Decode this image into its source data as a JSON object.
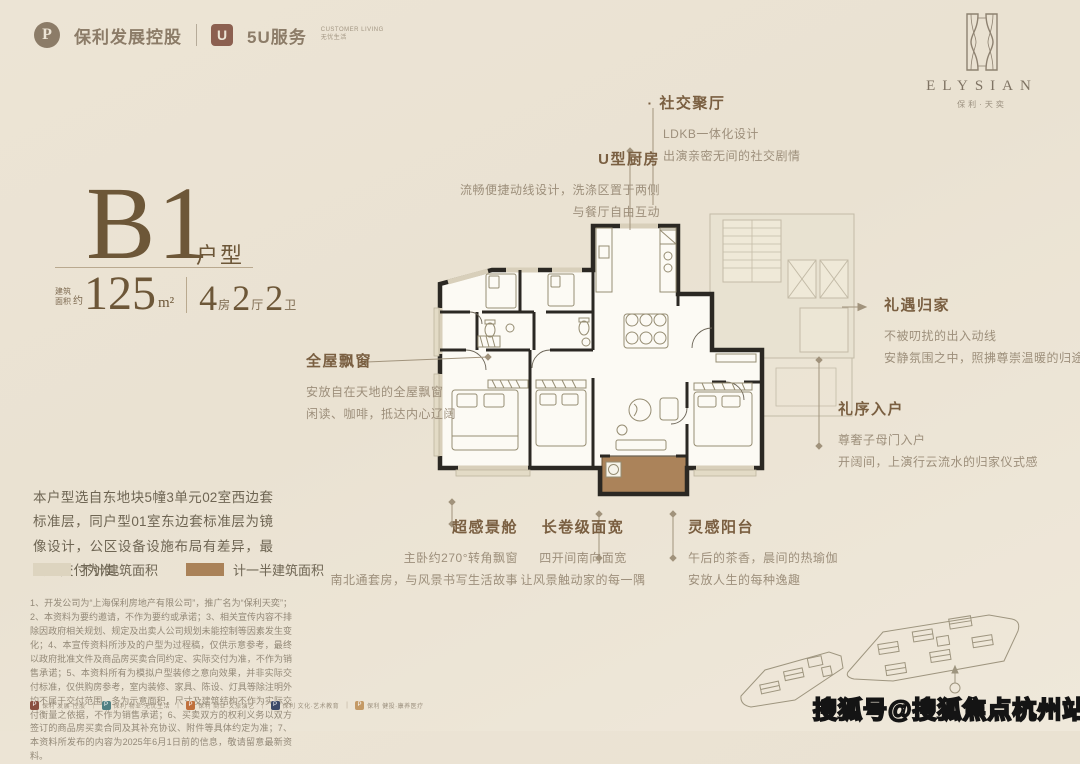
{
  "header": {
    "poly_logo": {
      "icon": "P",
      "name": "保利",
      "suffix": "发展控股"
    },
    "service_logo": {
      "icon": "U",
      "name": "5U服务",
      "sub1": "CUSTOMER LIVING",
      "sub2": "无忧生活"
    }
  },
  "brand": {
    "name_en": "ELYSIAN",
    "name_cn": "保利·天奕"
  },
  "unit": {
    "code": "B1",
    "type_label": "户型",
    "area_prefix_line1": "建筑",
    "area_prefix_line2": "面积",
    "area_approx": "约",
    "area_value": "125",
    "area_unit": "m²",
    "rooms": [
      {
        "num": "4",
        "label": "房"
      },
      {
        "num": "2",
        "label": "厅"
      },
      {
        "num": "2",
        "label": "卫"
      }
    ]
  },
  "description": "本户型选自东地块5幢3单元02室西边套标准层，同户型01室东边套标准层为镜像设计，公区设备设施布局有差异，最终以交付为准。",
  "legend": [
    {
      "label": "不计建筑面积",
      "color": "#ddd4bf"
    },
    {
      "label": "计一半建筑面积",
      "color": "#aa8258"
    }
  ],
  "annotations": {
    "social": {
      "title": "社交聚厅",
      "lines": [
        "LDKB一体化设计",
        "出演亲密无间的社交剧情"
      ]
    },
    "kitchen": {
      "title": "U型厨房",
      "lines": [
        "流畅便捷动线设计，洗涤区置于两侧",
        "与餐厅自由互动"
      ]
    },
    "homecoming": {
      "title": "礼遇归家",
      "lines": [
        "不被叨扰的出入动线",
        "安静氛围之中，照拂尊崇温暖的归途"
      ]
    },
    "entry": {
      "title": "礼序入户",
      "lines": [
        "尊奢子母门入户",
        "开阔间，上演行云流水的归家仪式感"
      ]
    },
    "baywindow": {
      "title": "全屋飘窗",
      "lines": [
        "安放自在天地的全屋飘窗",
        "闲读、咖啡，抵达内心辽阔"
      ]
    },
    "viewcabin": {
      "title": "超感景舱",
      "lines": [
        "主卧约270°转角飘窗",
        "南北通套房，与风景书写生活故事"
      ]
    },
    "frontwidth": {
      "title": "长卷级面宽",
      "lines": [
        "四开间南向面宽",
        "让风景触动家的每一隅"
      ]
    },
    "balcony": {
      "title": "灵感阳台",
      "lines": [
        "午后的茶香，晨间的热瑜伽",
        "安放人生的每种逸趣"
      ]
    }
  },
  "disclaimer": "1、开发公司为“上海保利房地产有限公司”，推广名为“保利天奕”；2、本资料为要约邀请，不作为要约或承诺；3、相关宣传内容不排除因政府相关规划、规定及出卖人公司规划未能控制等因素发生变化；4、本宣传资料所涉及的户型为过程稿，仅供示意参考，最终以政府批准文件及商品房买卖合同约定、实际交付为准，不作为销售承诺；5、本资料所有为模拟户型装修之意向效果，并非实际交付标准，仅供购房参考，室内装修、家具、陈设、灯具等除注明外均不属于交付范围，多为示意面积，尺寸及建筑结构不作为实际交付衡量之依据，不作为销售承诺；6、买卖双方的权利义务以双方签订的商品房买卖合同及其补充协议、附件等具体约定为准；7、本资料所发布的内容为2025年6月1日前的信息，敬请留意最新资料。",
  "footer_logos": [
    {
      "color": "#8a4f3f",
      "label": "保利 发展·控股"
    },
    {
      "color": "#4f7f82",
      "label": "保利 物业·无忧生活"
    },
    {
      "color": "#c0703c",
      "label": "保利 商业·文旅演艺"
    },
    {
      "color": "#3c4a68",
      "label": "保利 文化·艺术教育"
    },
    {
      "color": "#c49a66",
      "label": "保利 健投·康养医疗"
    }
  ],
  "watermark": "搜狐号@搜狐焦点杭州站",
  "colors": {
    "background": "#ebe3d4",
    "accent_brown": "#6d5738",
    "annotation_title": "#7a5f41",
    "annotation_body": "#9d8f7b",
    "wall_dark": "#2b2823",
    "balcony_fill": "#ab835a",
    "legend_light": "#ddd4bf",
    "core_ghost": "#c3bba7"
  }
}
